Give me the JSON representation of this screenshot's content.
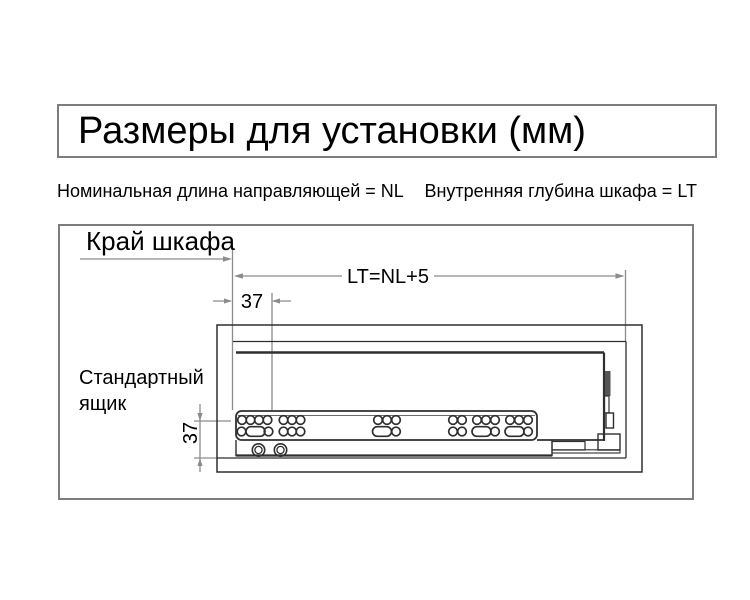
{
  "title": "Размеры для установки (мм)",
  "legend": {
    "nominal_length": "Номинальная длина направляющей = NL",
    "cabinet_depth": "Внутренняя глубина шкафа = LT"
  },
  "diagram": {
    "cabinet_edge_label": "Край шкафа",
    "drawer_label": "Стандартный ящик",
    "dim_lt_label": "LT=NL+5",
    "dim_front_offset_label": "37",
    "dim_height_label": "37"
  },
  "colors": {
    "background": "#ffffff",
    "border_gray": "#7d7d7d",
    "dimension_gray": "#8c8c8c",
    "drawing_dark": "#2f2f2f",
    "text_black": "#000000"
  }
}
